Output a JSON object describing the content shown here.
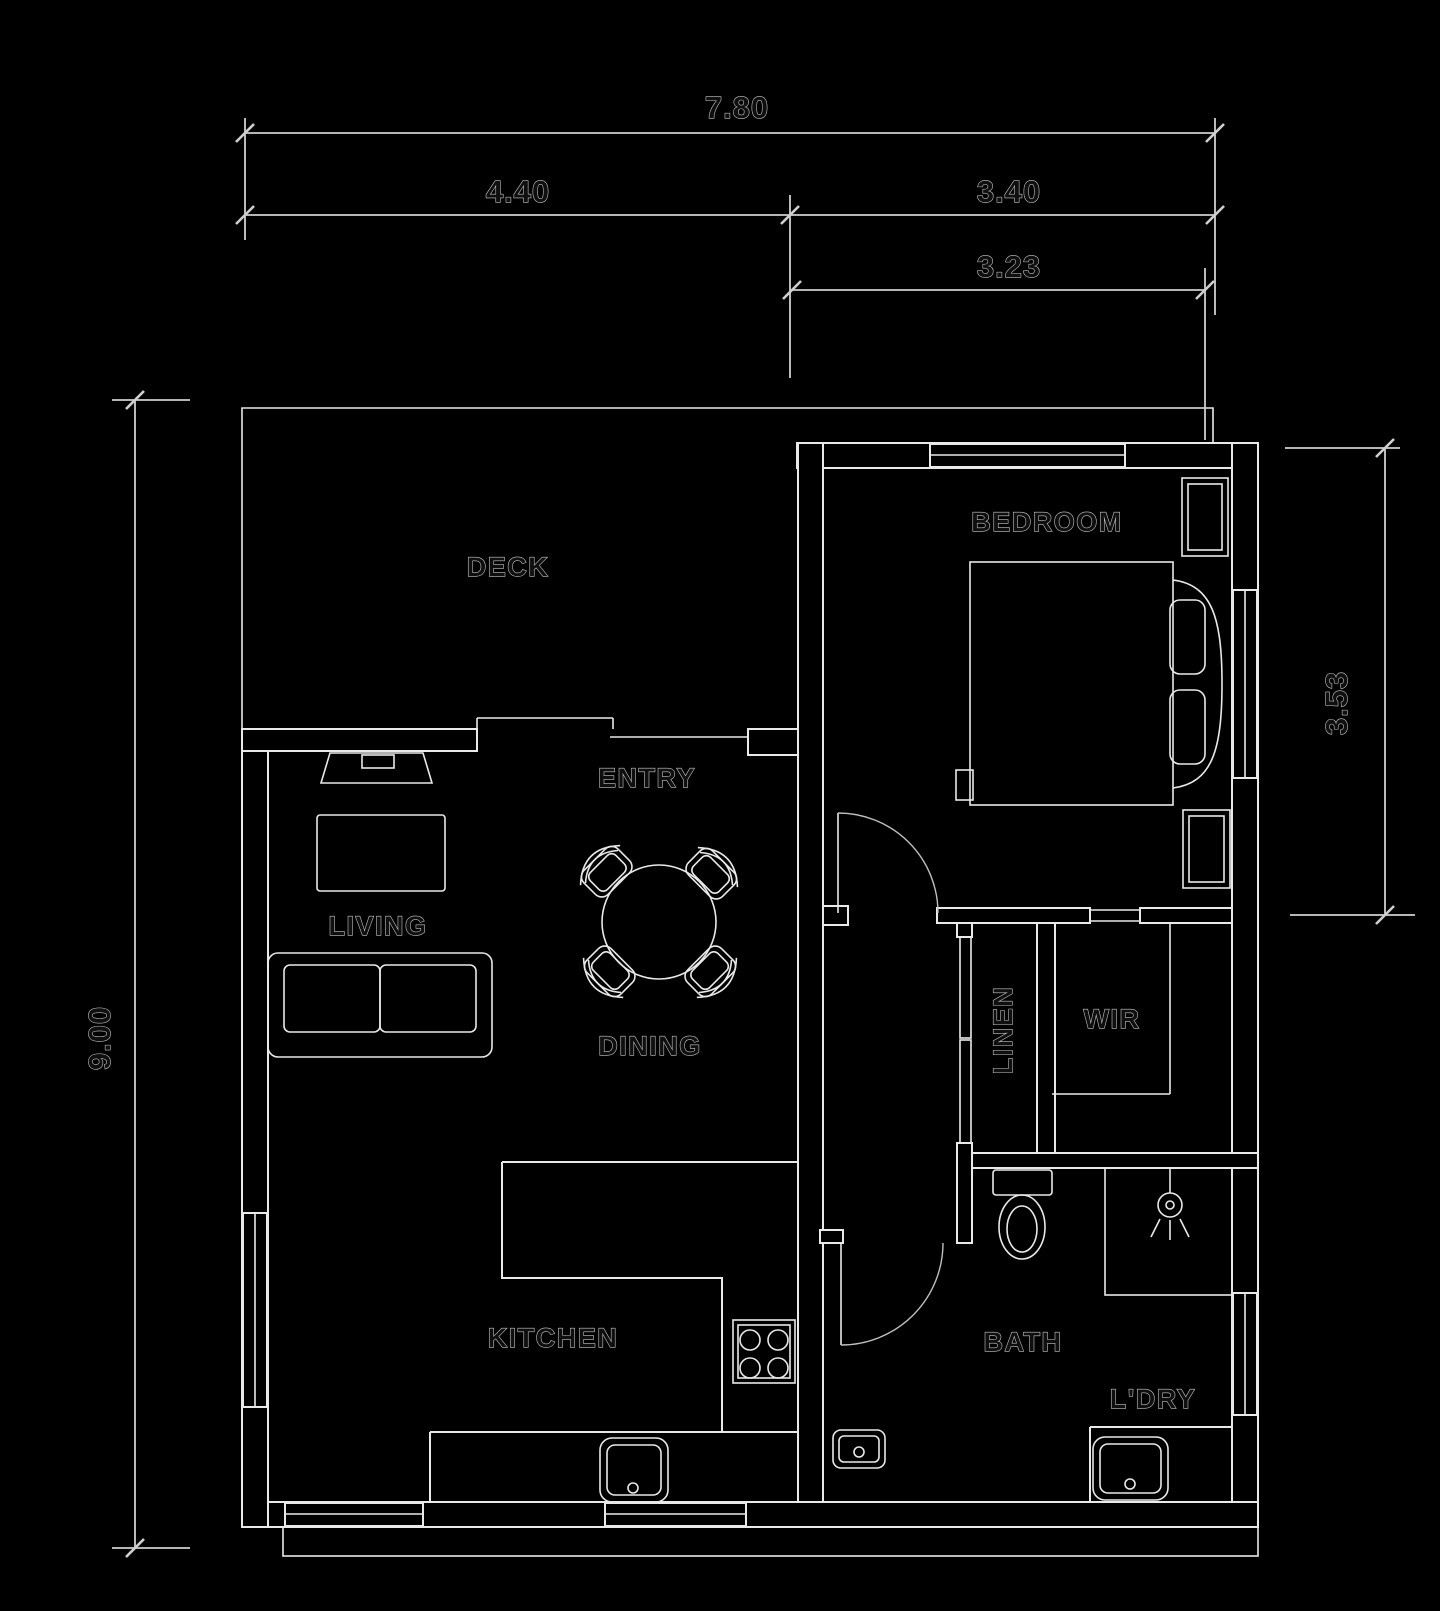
{
  "title": "One-bedroom floor plan",
  "colors": {
    "background": "#000000",
    "line": "#e9e9e9",
    "dim_line": "#cfcfcf",
    "wall_fill": "#000000",
    "text_fill": "#0f0f0f",
    "text_outline": "#c4c4c4"
  },
  "labels": {
    "deck": "DECK",
    "bedroom": "BEDROOM",
    "entry": "ENTRY",
    "living": "LIVING",
    "dining": "DINING",
    "linen": "LINEN",
    "wir": "WIR",
    "kitchen": "KITCHEN",
    "bath": "BATH",
    "laundry": "L'DRY"
  },
  "dimensions": {
    "total_width": "7.80",
    "living_width": "4.40",
    "bedroom_width": "3.40",
    "bedroom_internal_width": "3.23",
    "total_depth": "9.00",
    "bedroom_depth": "3.53"
  }
}
